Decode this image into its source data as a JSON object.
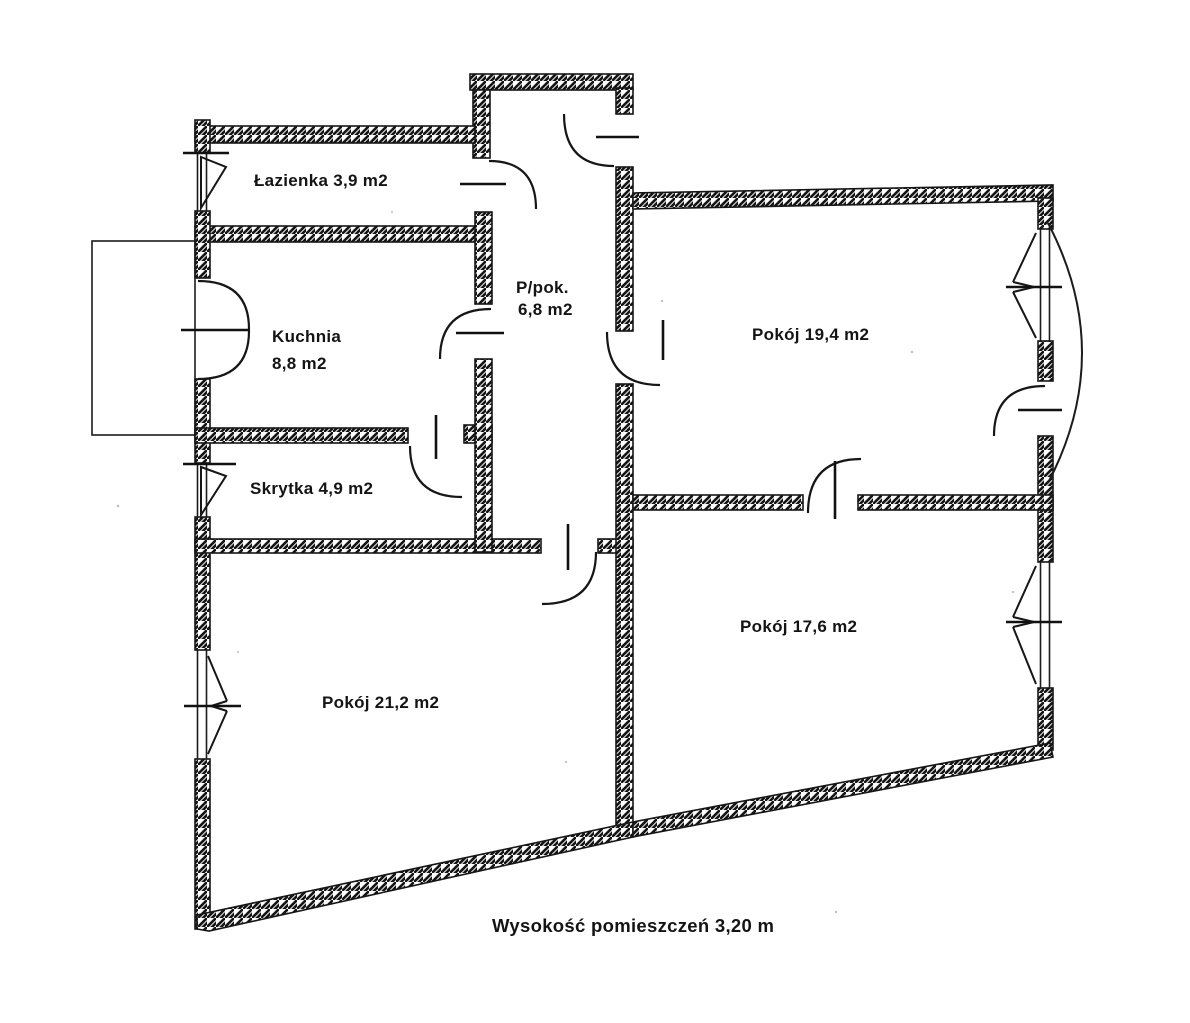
{
  "plan": {
    "rooms": {
      "lazienka": {
        "label": "Łazienka 3,9 m2"
      },
      "kuchnia": {
        "label": "Kuchnia",
        "area": "8,8 m2"
      },
      "ppok": {
        "label": "P/pok.",
        "area": "6,8 m2"
      },
      "pokoj_19": {
        "label": "Pokój 19,4 m2"
      },
      "skrytka": {
        "label": "Skrytka 4,9 m2"
      },
      "pokoj_21": {
        "label": "Pokój 21,2 m2"
      },
      "pokoj_17": {
        "label": "Pokój 17,6 m2"
      }
    },
    "caption": "Wysokość pomieszczeń 3,20 m",
    "colors": {
      "ink": "#161616",
      "paper": "#ffffff"
    }
  }
}
